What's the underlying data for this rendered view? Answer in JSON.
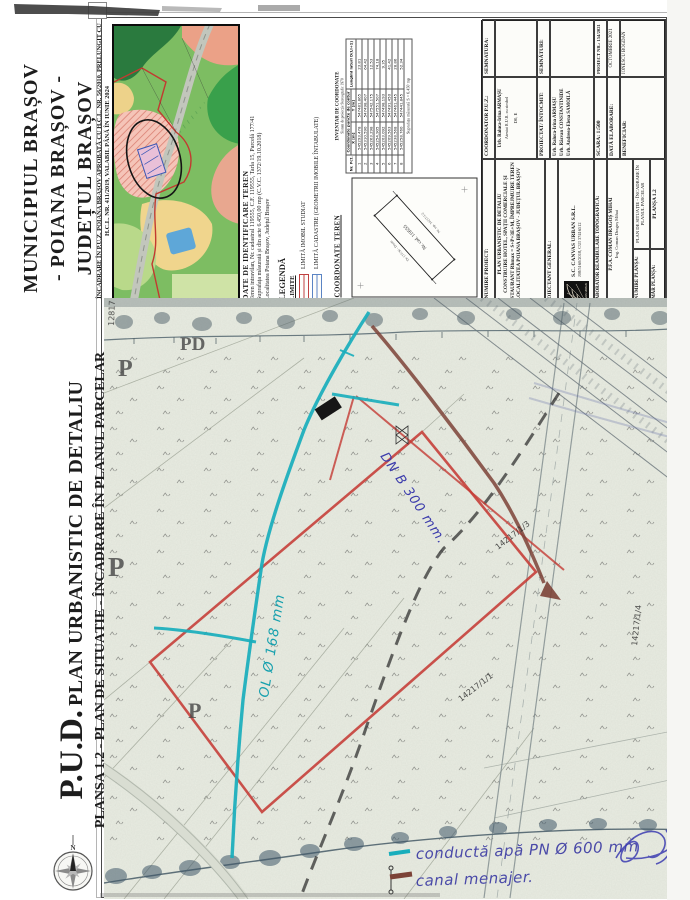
{
  "palette": {
    "parcel_red": "#c53b35",
    "pipe_cyan": "#18aebc",
    "canal_brown": "#7c4237",
    "ink_blue": "#4a4aa8",
    "legend_red": "#c04040",
    "legend_blue": "#5b84c4"
  },
  "muni": {
    "lines": [
      "MUNICIPIUL BRAȘOV",
      "- POIANA BRAȘOV -",
      "JUDEȚUL BRAȘOV"
    ]
  },
  "incadrare": {
    "line1": "ÎNCADRARE ÎN P.U.Z. POIANA BRAȘOV APROBATĂ CU H.C.L. NR. 56/2010, PRELUNGIT CU",
    "line2": "H.C.L. NR. 411/2019, VALABIL PÂNĂ ÎN IUNIE 2024"
  },
  "pud": {
    "big": "P.U.D.",
    "title": "PLAN URBANISTIC DE DETALIU",
    "subtitle": "PLANȘA 1.2 - PLAN DE SITUAȚIE - ÎNCADRARE ÎN PLANUL PARCELAR"
  },
  "ident": {
    "title": "DATE DE IDENTIFICARE TEREN",
    "lines": [
      "Teren intravilan, Nr. cadastral 119555, C.F. 119555, Tarla 15, Parcelă 177/41",
      "Suprafața măsurată și din acte 6.450,00 mp (C.V.C. 1372/19.10.2018)",
      "Localitatea Poiana Brașov, Județul Brașov"
    ]
  },
  "legend": {
    "title": "LEGENDĂ",
    "subtitle": "LIMITE",
    "items": [
      {
        "label": "LIMITĂ IMOBIL STUDIAT",
        "color": "#c04040"
      },
      {
        "label": "LIMITĂ CADASTRE (GEOMETRII IMOBILE ÎNTABULATE)",
        "color": "#5b84c4"
      }
    ]
  },
  "coords": {
    "panel_title": "COORDONATE TEREN",
    "table_title": "INVENTAR DE COORDONATE",
    "table_subtitle": "Sistem de proiecție Stereografic 1970",
    "col_pct": "Nr. Pct.",
    "col_group": "Coordonate puncte de contur",
    "col_x": "X [m]",
    "col_y": "Y [m]",
    "col_d": "Lungimi laturi D(i,i+1)",
    "rows": [
      {
        "n": "1",
        "x": "545293.478",
        "y": "547481.865",
        "d": "23.81"
      },
      {
        "n": "2",
        "x": "545310.590",
        "y": "547498.407",
        "d": "64.42"
      },
      {
        "n": "3",
        "x": "545263.298",
        "y": "547542.175",
        "d": "12.53"
      },
      {
        "n": "4",
        "x": "545254.905",
        "y": "547551.507",
        "d": "74.18"
      },
      {
        "n": "5",
        "x": "545203.092",
        "y": "547498.193",
        "d": "9.35"
      },
      {
        "n": "6",
        "x": "545209.563",
        "y": "547491.450",
        "d": "41.42"
      },
      {
        "n": "7",
        "x": "545238.568",
        "y": "547461.445",
        "d": "28.86"
      },
      {
        "n": "8",
        "x": "545258.760",
        "y": "547441.845",
        "d": "52.34"
      }
    ],
    "footer": "Suprafața măsurată S = 6.450 mp",
    "sketch_center": "Nr. cad. 119555",
    "sketch_edge_top": "De 177/30 - Drum",
    "sketch_edge_bottom": "Nr. top. 14217/1/2"
  },
  "tb": {
    "denumire_proiect": "DENUMIRE PROIECT:",
    "title_lines": [
      "PLAN URBANISTIC DE DETALIU",
      "CONSTRUIRE HOTEL, SPAȚII COMERCIALE ȘI RESTAURANT Rhmax = S+P+3E+M, ÎMPREJMUIRE TEREN",
      "LOCALITATEA POIANA BRAȘOV - JUDEȚUL BRAȘOV"
    ],
    "coordonator": "COORDONATOR P.U.Z.:",
    "coordonator_name": "Urb. Raluca-Irina ARMAȘU",
    "coordonator_atestat": "Atestat R.U.R. cu simbol",
    "coordonator_simbol": "D0, E",
    "semnatura": "SEMNATURA:",
    "proiectant_general": "PROIECTANT GENERAL:",
    "logo_name": "CANVAS URBAN",
    "company": "S.C. CANVAS URBAN S.R.L.",
    "company_reg": "J08/5160/2018, CUI 37416512",
    "elaborator": "ELABORATOR REAMBULARE TOPOGRAFICĂ:",
    "elaborator_name": "P.F.A. COMAN DRAGOȘ MIHAI",
    "elaborator_ing": "Ing. Coman Dragoș Mihai",
    "proiectat": "PROIECTAT/ ÎNTOCMIT:",
    "proiectat_names": [
      "Urb. Raluca-Irina ARMAȘU",
      "Urb. Răzvan CONSTANTINIDE",
      "Urb. Andreea-Elena SAMOILĂ"
    ],
    "semnaturi": "SEMNĂTURI:",
    "denumire_plansa": "DENUMIRE PLANȘA:",
    "plansa_name": "PLAN DE SITUAȚIE - ÎNCADRARE ÎN PLANUL PARCELAR",
    "numar_plansa": "NUMĂR PLANȘA:",
    "plansa_nr": "PLANȘA 1.2",
    "scara": "SCARA: 1:500",
    "data_lbl": "DATĂ ELABORARE:",
    "data_val": "OCTOMBRIE 2021",
    "beneficiar": "BENEFICIAR:",
    "beneficiar_val": "IONESCU BOGDAN",
    "proiect_nr": "PROIECT NR.: 154/2021"
  },
  "map": {
    "letters": {
      "p1": "P",
      "pd": "PD",
      "p2": "P",
      "p3": "P"
    },
    "numbers": {
      "n1": "14217/1/3",
      "n2": "14217/1/4",
      "n3": "14217/1/1",
      "n4": "12817"
    },
    "hand": {
      "pipe": "OL Ø 168 mm",
      "canal": "DN B 300 mm.",
      "leg1": "conductă apă PN Ø 600 mm",
      "leg2": "canal menajer."
    }
  },
  "compass": {
    "n": "N"
  }
}
